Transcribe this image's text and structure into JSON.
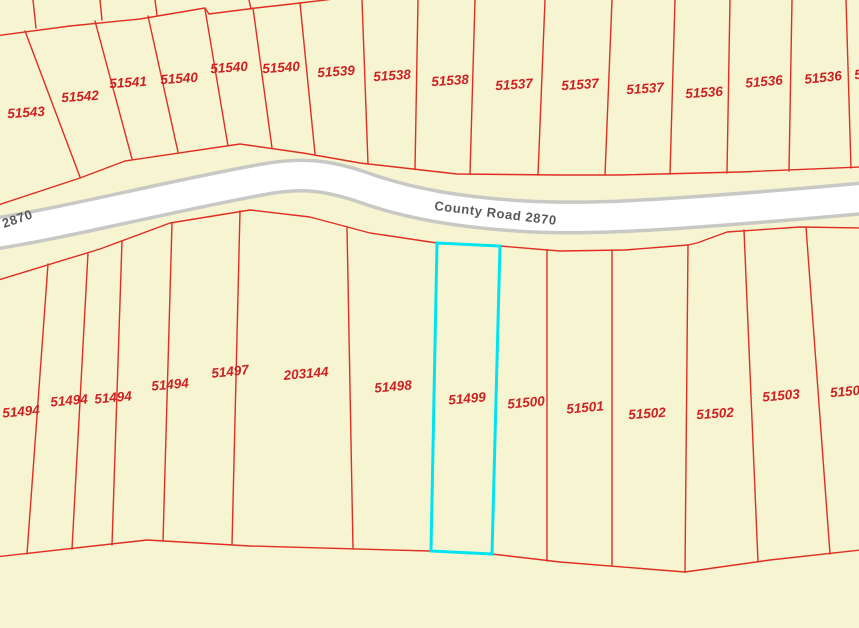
{
  "map": {
    "background_color": "#F7F4D2",
    "boundary_color": "#E02E22",
    "label_color": "#CC2222",
    "highlight_color": "#00E4F2",
    "highlighted_parcel_id": "51499",
    "road": {
      "label": "County Road 2870",
      "left_edge_label": "2870",
      "surface_color": "#FFFFFF",
      "casing_color": "#C8C8C4",
      "label_color": "#58595A"
    },
    "top_row_labels": [
      "51543",
      "51542",
      "51541",
      "51540",
      "51540",
      "51540",
      "51539",
      "51538",
      "51538",
      "51537",
      "51537",
      "51537",
      "51536",
      "51536",
      "51536",
      "5"
    ],
    "bottom_row_labels": [
      "51494",
      "51494",
      "51494",
      "51494",
      "51497",
      "203144",
      "51498",
      "51499",
      "51500",
      "51501",
      "51502",
      "51502",
      "51503",
      "5150"
    ]
  }
}
